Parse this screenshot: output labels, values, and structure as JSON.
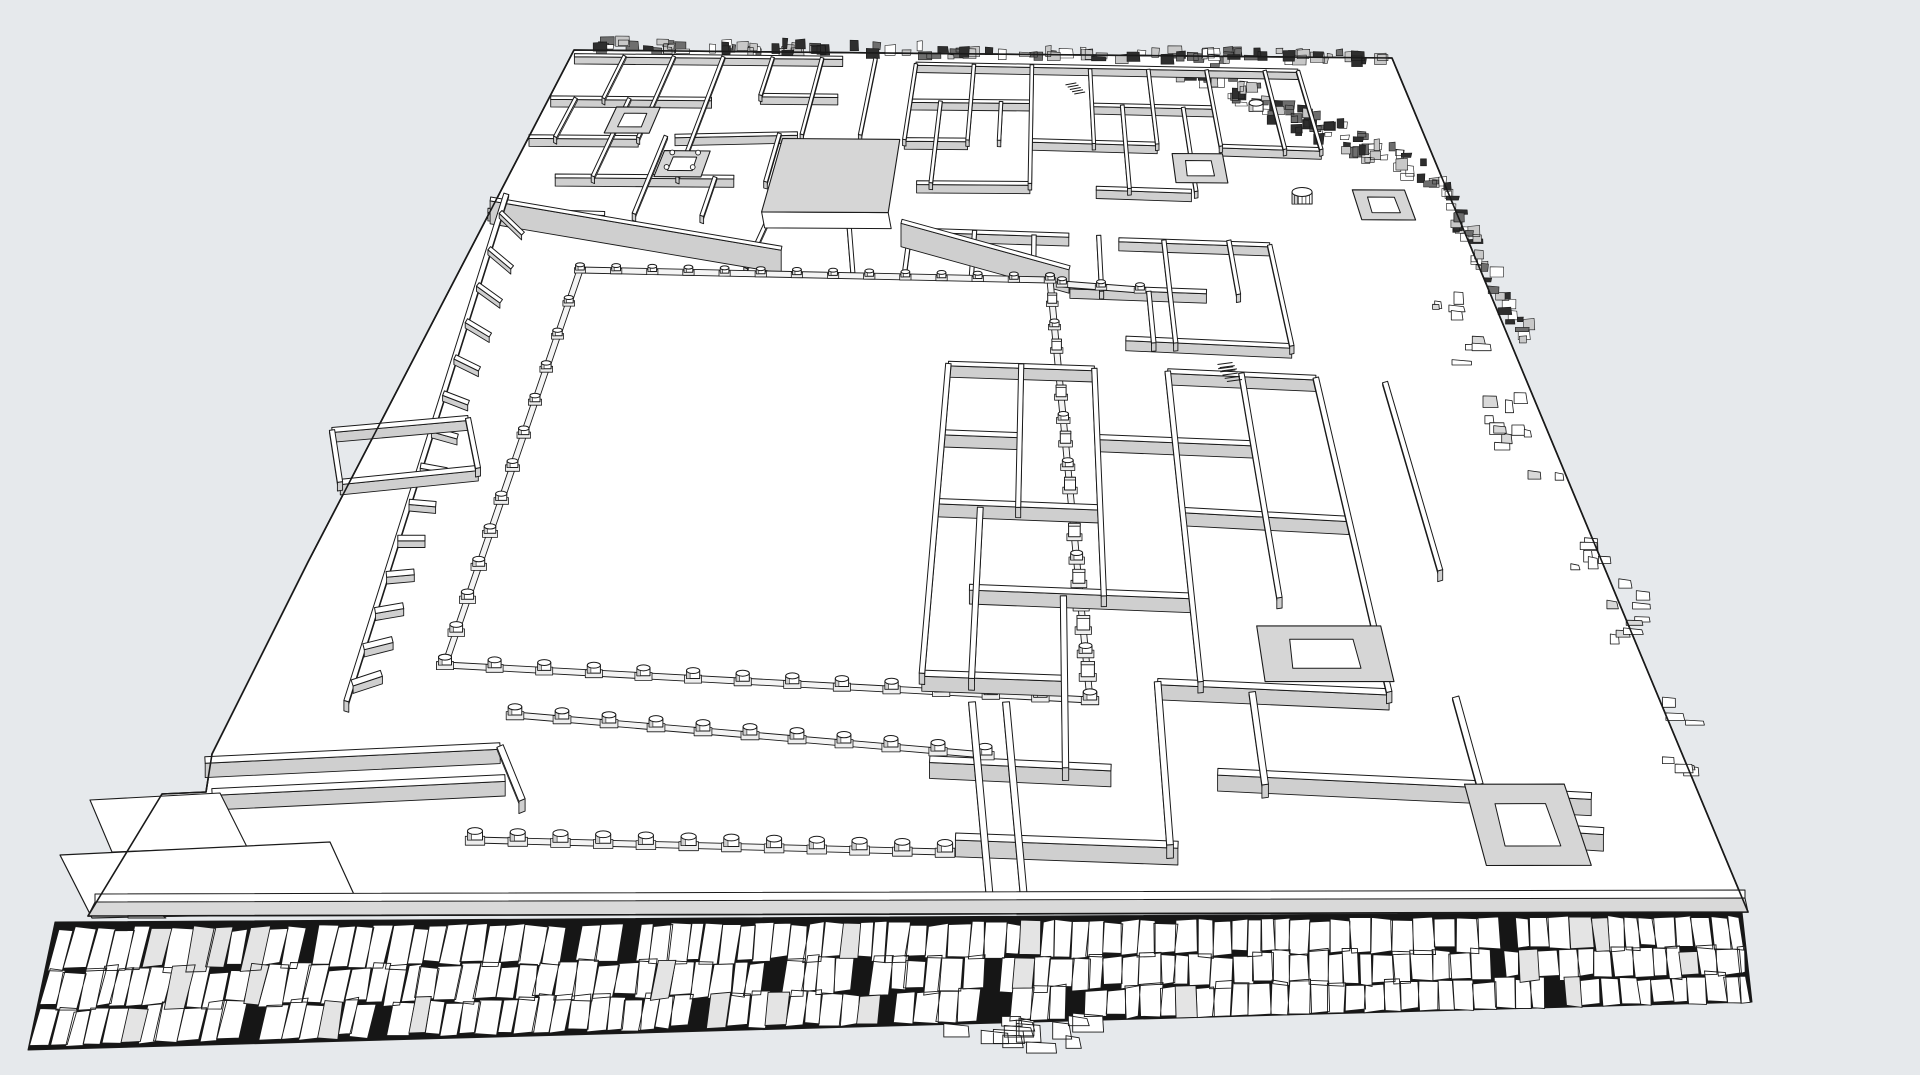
{
  "scene": {
    "width": 1920,
    "height": 1075,
    "background": "#e6e9ec",
    "line_color": "#1a1a1a",
    "surface_color": "#ffffff",
    "wall_face_color": "#cfcfcf",
    "wall_face_light": "#dfdfdf",
    "terrace_top_color": "#d6d6d6",
    "stone_gap_color": "#161616",
    "stone_alt_color": "#e4e4e4",
    "base_color": "#ededed",
    "seed": 7
  },
  "platform": {
    "outline": [
      [
        574,
        50
      ],
      [
        1392,
        58
      ],
      [
        1748,
        912
      ],
      [
        88,
        916
      ],
      [
        162,
        794
      ],
      [
        206,
        792
      ],
      [
        212,
        754
      ],
      [
        308,
        562
      ]
    ],
    "corners": {
      "tl": [
        574,
        50
      ],
      "tr": [
        1392,
        58
      ],
      "br": [
        1748,
        912
      ],
      "bl": [
        88,
        916
      ]
    }
  },
  "court": {
    "corners": [
      [
        580,
        270
      ],
      [
        1050,
        280
      ],
      [
        1090,
        700
      ],
      [
        445,
        665
      ]
    ],
    "columns": {
      "north": 14,
      "west": 13,
      "east": 19,
      "south": 14
    },
    "north_extension": {
      "from": [
        1062,
        284
      ],
      "to": [
        1140,
        290
      ],
      "count": 3
    }
  },
  "porticoes": {
    "upper": {
      "from": [
        515,
        715
      ],
      "to": [
        985,
        755
      ],
      "count": 11
    },
    "lower": {
      "from": [
        475,
        840
      ],
      "to": [
        945,
        852
      ],
      "count": 12
    }
  },
  "causeway": {
    "walls": [
      [
        [
          972,
          702
        ],
        [
          990,
          900
        ]
      ],
      [
        [
          1006,
          702
        ],
        [
          1024,
          898
        ]
      ]
    ]
  },
  "gray_bands": [
    [
      0.0,
      0.172,
      0.315,
      0.227
    ],
    [
      0.43,
      0.195,
      0.6,
      0.248
    ]
  ],
  "west_wing": {
    "facade": [
      0.0136,
      0.166,
      0.095,
      0.752
    ],
    "teeth": 14,
    "porch_walls": [
      [
        [
          332,
          430
        ],
        [
          468,
          418
        ]
      ],
      [
        [
          340,
          482
        ],
        [
          478,
          468
        ]
      ],
      [
        [
          332,
          430
        ],
        [
          340,
          482
        ]
      ],
      [
        [
          468,
          418
        ],
        [
          478,
          468
        ]
      ]
    ]
  },
  "complexes": {
    "northwest": {
      "walls": [
        [
          0.004,
          0.006,
          0.33,
          0.006
        ],
        [
          0.004,
          0.055,
          0.19,
          0.055
        ],
        [
          0.245,
          0.05,
          0.335,
          0.05
        ],
        [
          0.004,
          0.1,
          0.125,
          0.1
        ],
        [
          0.165,
          0.098,
          0.3,
          0.094
        ],
        [
          0.055,
          0.145,
          0.245,
          0.145
        ],
        [
          0.004,
          0.185,
          0.125,
          0.188
        ],
        [
          0.065,
          0.006,
          0.065,
          0.055
        ],
        [
          0.125,
          0.006,
          0.125,
          0.1
        ],
        [
          0.185,
          0.006,
          0.185,
          0.145
        ],
        [
          0.245,
          0.006,
          0.245,
          0.05
        ],
        [
          0.305,
          0.006,
          0.305,
          0.095
        ],
        [
          0.37,
          0.006,
          0.37,
          0.095
        ],
        [
          0.033,
          0.055,
          0.033,
          0.1
        ],
        [
          0.095,
          0.055,
          0.095,
          0.145
        ],
        [
          0.155,
          0.098,
          0.155,
          0.188
        ],
        [
          0.225,
          0.145,
          0.225,
          0.19
        ],
        [
          0.28,
          0.094,
          0.28,
          0.15
        ],
        [
          0.295,
          0.185,
          0.285,
          0.25
        ],
        [
          0.375,
          0.19,
          0.39,
          0.255
        ]
      ],
      "sunken": [
        [
          0.085,
          0.065,
          0.135,
          0.095
        ]
      ],
      "pit": [
        0.16,
        0.115,
        0.21,
        0.145
      ],
      "porch": [
        0.285,
        0.1,
        0.415,
        0.185
      ]
    },
    "northeast": {
      "walls": [
        [
          0.42,
          0.012,
          0.88,
          0.016
        ],
        [
          0.42,
          0.055,
          0.56,
          0.055
        ],
        [
          0.63,
          0.058,
          0.77,
          0.06
        ],
        [
          0.42,
          0.1,
          0.49,
          0.1
        ],
        [
          0.56,
          0.1,
          0.7,
          0.103
        ],
        [
          0.77,
          0.105,
          0.88,
          0.108
        ],
        [
          0.44,
          0.15,
          0.56,
          0.15
        ],
        [
          0.63,
          0.155,
          0.73,
          0.158
        ],
        [
          0.42,
          0.012,
          0.42,
          0.1
        ],
        [
          0.49,
          0.012,
          0.49,
          0.1
        ],
        [
          0.56,
          0.012,
          0.56,
          0.15
        ],
        [
          0.63,
          0.016,
          0.63,
          0.103
        ],
        [
          0.7,
          0.016,
          0.7,
          0.103
        ],
        [
          0.77,
          0.016,
          0.77,
          0.105
        ],
        [
          0.84,
          0.016,
          0.84,
          0.108
        ],
        [
          0.88,
          0.016,
          0.88,
          0.108
        ],
        [
          0.455,
          0.055,
          0.455,
          0.15
        ],
        [
          0.525,
          0.055,
          0.525,
          0.1
        ],
        [
          0.665,
          0.058,
          0.665,
          0.155
        ],
        [
          0.735,
          0.06,
          0.735,
          0.158
        ]
      ],
      "sunken": [
        [
          0.715,
          0.114,
          0.77,
          0.148
        ]
      ],
      "stairs": [
        [
          0.6,
          0.035
        ]
      ]
    },
    "east_central": {
      "walls": [
        [
          0.44,
          0.205,
          0.6,
          0.21
        ],
        [
          0.65,
          0.215,
          0.8,
          0.22
        ],
        [
          0.44,
          0.265,
          0.53,
          0.268
        ],
        [
          0.6,
          0.27,
          0.73,
          0.275
        ],
        [
          0.46,
          0.325,
          0.58,
          0.33
        ],
        [
          0.65,
          0.33,
          0.8,
          0.338
        ],
        [
          0.44,
          0.205,
          0.44,
          0.265
        ],
        [
          0.505,
          0.205,
          0.505,
          0.268
        ],
        [
          0.565,
          0.21,
          0.565,
          0.33
        ],
        [
          0.63,
          0.21,
          0.63,
          0.275
        ],
        [
          0.695,
          0.215,
          0.695,
          0.335
        ],
        [
          0.76,
          0.215,
          0.76,
          0.278
        ],
        [
          0.8,
          0.22,
          0.8,
          0.338
        ],
        [
          0.48,
          0.265,
          0.48,
          0.328
        ],
        [
          0.675,
          0.275,
          0.675,
          0.335
        ]
      ],
      "sunken": [
        [
          0.9,
          0.155,
          0.955,
          0.19
        ]
      ],
      "stairs": [
        [
          0.55,
          0.28
        ],
        [
          0.73,
          0.36
        ]
      ]
    },
    "southeast": {
      "walls": [
        [
          0.49,
          0.36,
          0.62,
          0.365
        ],
        [
          0.685,
          0.368,
          0.815,
          0.375
        ],
        [
          0.49,
          0.44,
          0.555,
          0.443
        ],
        [
          0.62,
          0.445,
          0.75,
          0.452
        ],
        [
          0.49,
          0.52,
          0.62,
          0.527
        ],
        [
          0.685,
          0.53,
          0.815,
          0.54
        ],
        [
          0.52,
          0.62,
          0.685,
          0.63
        ],
        [
          0.49,
          0.72,
          0.59,
          0.726
        ],
        [
          0.655,
          0.73,
          0.815,
          0.742
        ],
        [
          0.5,
          0.82,
          0.62,
          0.83
        ],
        [
          0.69,
          0.835,
          0.86,
          0.85
        ],
        [
          0.52,
          0.91,
          0.66,
          0.92
        ],
        [
          0.49,
          0.36,
          0.49,
          0.72
        ],
        [
          0.555,
          0.36,
          0.555,
          0.527
        ],
        [
          0.62,
          0.365,
          0.62,
          0.63
        ],
        [
          0.685,
          0.368,
          0.685,
          0.73
        ],
        [
          0.75,
          0.37,
          0.75,
          0.632
        ],
        [
          0.815,
          0.375,
          0.815,
          0.742
        ],
        [
          0.875,
          0.38,
          0.875,
          0.6
        ],
        [
          0.525,
          0.527,
          0.525,
          0.726
        ],
        [
          0.59,
          0.63,
          0.59,
          0.83
        ],
        [
          0.655,
          0.73,
          0.655,
          0.92
        ],
        [
          0.72,
          0.742,
          0.72,
          0.85
        ],
        [
          0.86,
          0.748,
          0.86,
          0.85
        ],
        [
          0.89,
          0.86,
          0.93,
          0.864
        ],
        [
          0.89,
          0.86,
          0.89,
          0.9
        ],
        [
          0.89,
          0.9,
          0.93,
          0.905
        ]
      ],
      "sunken": [
        [
          0.73,
          0.665,
          0.82,
          0.73
        ],
        [
          0.85,
          0.85,
          0.915,
          0.945
        ]
      ],
      "stairs": [
        [
          0.73,
          0.365
        ]
      ]
    }
  },
  "cylinders": [
    {
      "u": 0.818,
      "v": 0.064,
      "r": 7,
      "fluted": false
    },
    {
      "u": 0.843,
      "v": 0.172,
      "r": 10,
      "fluted": true
    }
  ],
  "terraces": {
    "walls": [
      [
        [
          205,
          760
        ],
        [
          500,
          746
        ]
      ],
      [
        [
          212,
          792
        ],
        [
          505,
          778
        ]
      ],
      [
        [
          500,
          746
        ],
        [
          522,
          800
        ]
      ]
    ],
    "low_quad": [
      [
        60,
        855
      ],
      [
        330,
        842
      ],
      [
        362,
        912
      ],
      [
        92,
        918
      ]
    ],
    "step_quad": [
      [
        90,
        800
      ],
      [
        220,
        793
      ],
      [
        247,
        847
      ],
      [
        112,
        852
      ]
    ],
    "notch_triangle": [
      [
        128,
        894
      ],
      [
        166,
        918
      ],
      [
        128,
        918
      ]
    ]
  },
  "front_wall": {
    "lip": [
      [
        95,
        894
      ],
      [
        1745,
        890
      ],
      [
        1745,
        899
      ],
      [
        95,
        903
      ]
    ],
    "face": [
      [
        95,
        902
      ],
      [
        1745,
        898
      ],
      [
        1748,
        912
      ],
      [
        88,
        916
      ]
    ]
  },
  "paving_band": {
    "bg": [
      [
        55,
        922
      ],
      [
        1742,
        912
      ],
      [
        1752,
        1002
      ],
      [
        28,
        1050
      ]
    ],
    "top_from": [
      60,
      928
    ],
    "top_to": [
      1740,
      916
    ],
    "bot_from": [
      30,
      1046
    ],
    "bot_to": [
      1750,
      1002
    ],
    "rows": [
      0,
      0.36,
      0.68,
      1.0
    ],
    "cell_width": 17,
    "spill": {
      "t_from": 0.545,
      "t_to": 0.615,
      "count": 14,
      "max_drop": 30
    }
  },
  "back_rubble": {
    "from": [
      598,
      46
    ],
    "to": [
      1388,
      58
    ],
    "width": 11,
    "count": 120
  },
  "right_rubble": [
    {
      "from": [
        1170,
        62
      ],
      "to": [
        1432,
        176
      ],
      "width": 26,
      "count": 85
    },
    {
      "from": [
        1432,
        176
      ],
      "to": [
        1530,
        340
      ],
      "width": 16,
      "count": 42
    }
  ],
  "debris": {
    "from": [
      1460,
      300
    ],
    "to": [
      1690,
      740
    ],
    "clusters": 10
  }
}
